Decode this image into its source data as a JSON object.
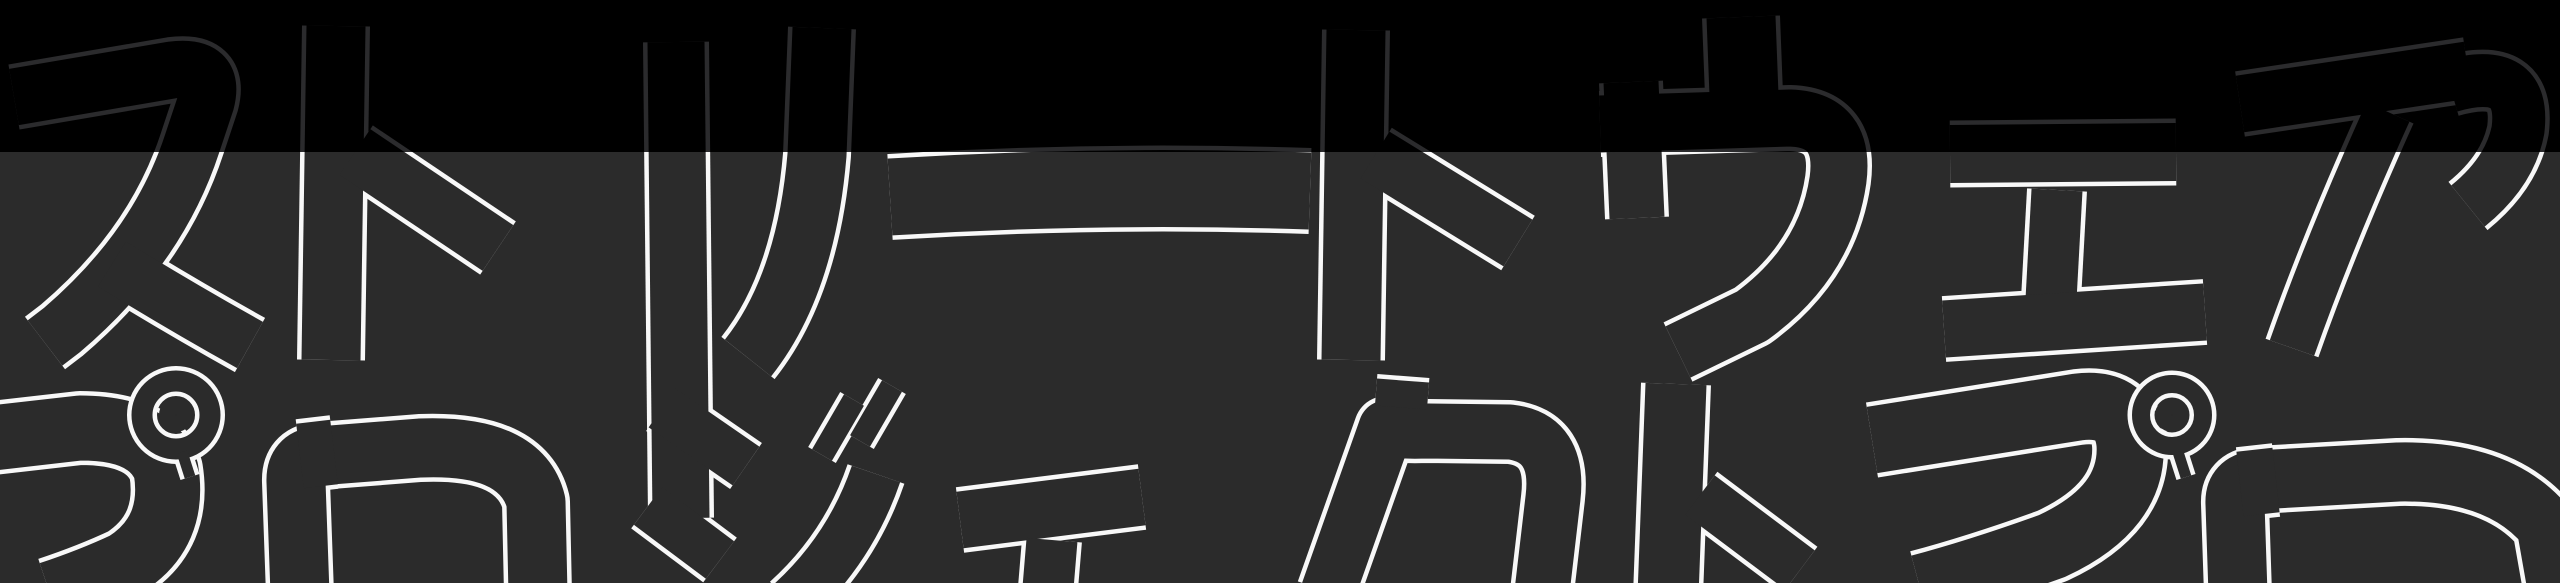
{
  "hero": {
    "description": "Full-width typographic hero banner with huge outlined katakana lettering, playfully rotated glyphs, split into a black top band and a dark gray lower band",
    "line1_text": "ストリートウェア",
    "line2_text": "プロジェクトプロ",
    "line1_label": "streetwear headline (katakana, outlined)",
    "line2_label": "project headline (katakana, outlined, cropped at bottom edge)"
  },
  "style": {
    "top_band_bg": "#000000",
    "top_band_stroke": "#2b2b2d",
    "bottom_band_bg": "#2b2b2b",
    "bottom_band_stroke": "#f8f8f8"
  }
}
